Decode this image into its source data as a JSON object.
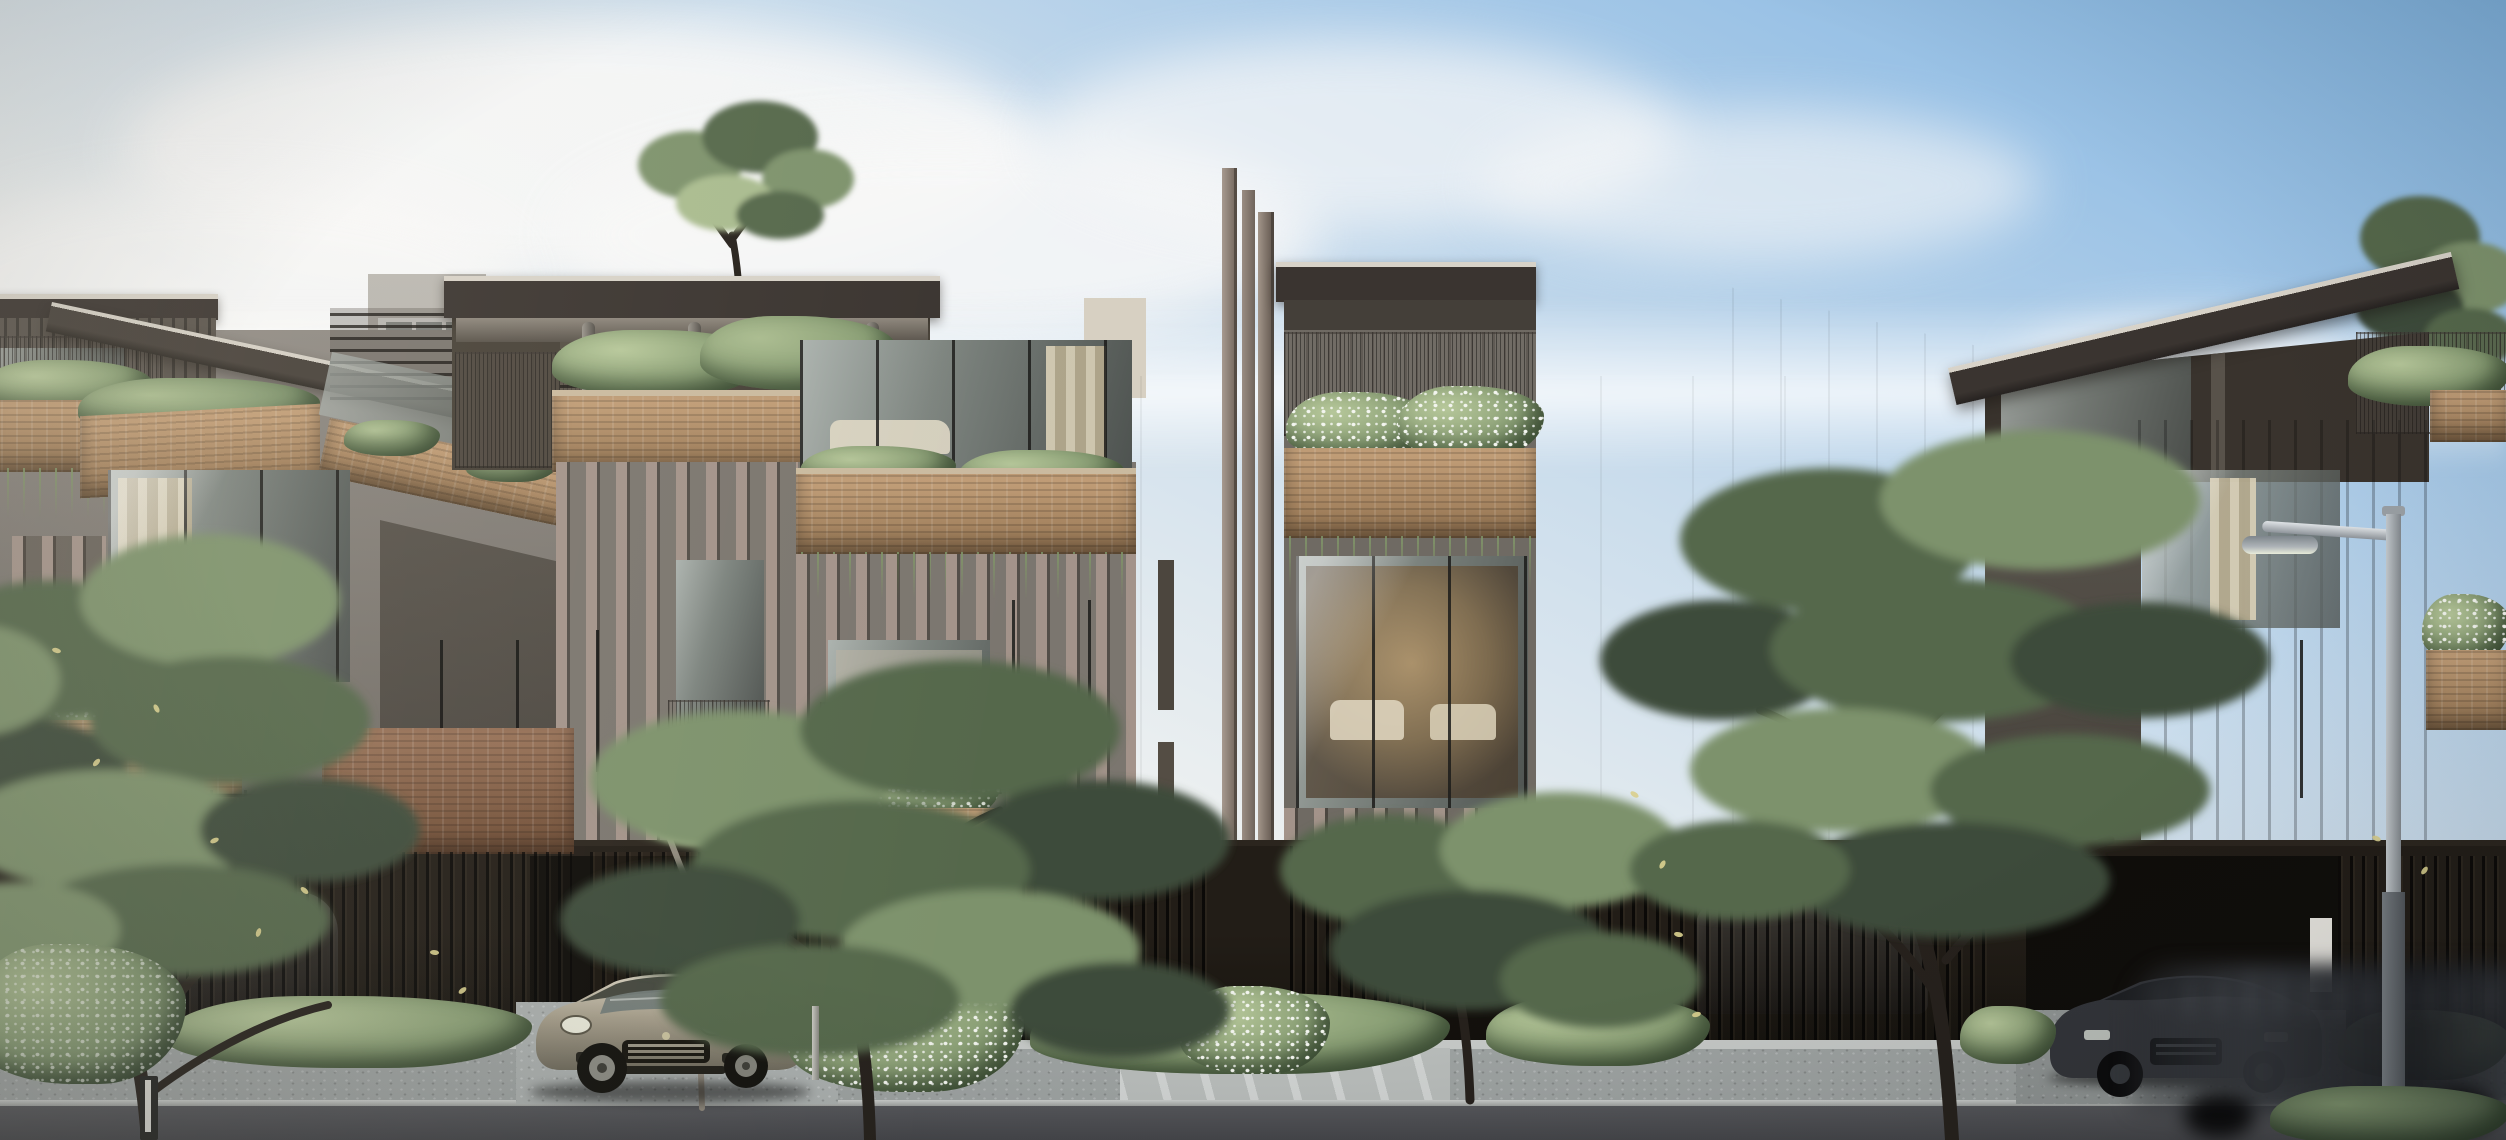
{
  "sign": {
    "block_label": "SD",
    "unit_number": "06"
  },
  "palette": {
    "sky_blue": "#7fb2de",
    "sky_mid": "#c9dcec",
    "sky_haze": "#edf0f0",
    "cloud": "#f8f8f8",
    "roof_dark": "#3a3430",
    "roof_edge": "#d7d2c8",
    "soffit": "#8d867c",
    "soffit_dark": "#58524a",
    "facade": "#8a857e",
    "facade_dark": "#5f5a53",
    "panel_dark": "#46413b",
    "cream": "#d7d0c2",
    "cream_shade": "#c3bbad",
    "taupe": "#b1a698",
    "fin": "#a3938a",
    "fin_dark": "#6b5f57",
    "mast": "#9a8c82",
    "brick": "#bd9468",
    "brick_dark": "#8a5f42",
    "hedge": "#8ba076",
    "hedge_light": "#b6c79a",
    "hedge_dark": "#576b4c",
    "tree_light": "#a9bb8f",
    "tree_mid": "#7d926c",
    "tree_dark": "#55684b",
    "tree_deep": "#3c4b3a",
    "trunk": "#26211c",
    "trunk_light": "#90897d",
    "glass_hi": "#abb2ae",
    "glass": "#7d847f",
    "glass_dark": "#4e5350",
    "interior_warm": "#c69c64",
    "fence": "#211c16",
    "fence_cap": "#6e6250",
    "walk": "#9ea3a2",
    "walk_light": "#c6c9c7",
    "road": "#45464a",
    "curb": "#cbcecc",
    "car_body": "#a79f8c",
    "car_hi": "#d7d1c0",
    "suv_dark": "#35373b",
    "lamp_metal": "#c4cace",
    "leaf": "#d9cf8e",
    "white": "#e9e7e1",
    "flower": "#f3f5ef"
  },
  "scene": {
    "type": "architectural exterior rendering",
    "subject": "modern multi-storey terrace residences with planted balconies, street trees and vehicles"
  }
}
